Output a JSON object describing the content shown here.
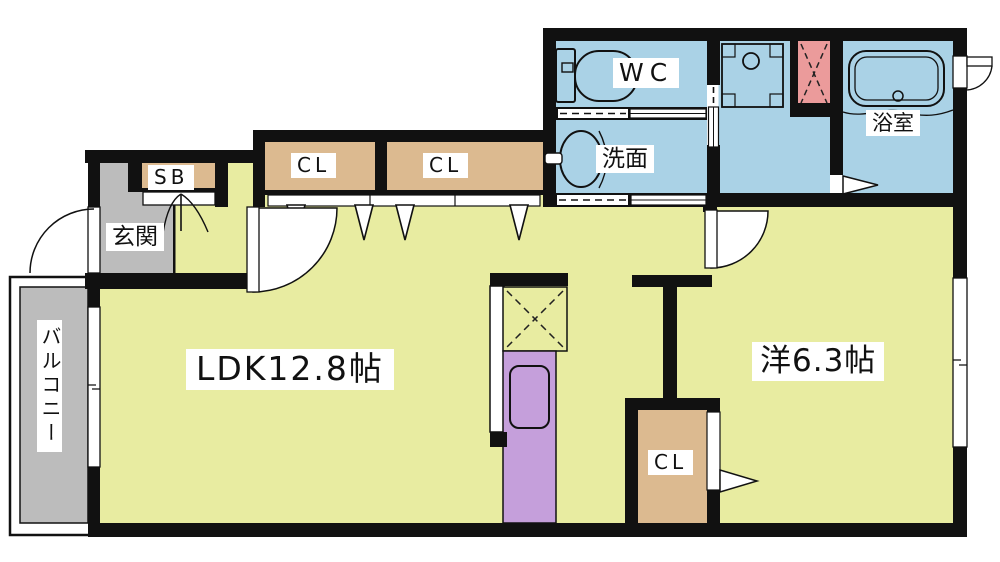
{
  "page": {
    "type": "apartment-floor-plan",
    "background": "#ffffff"
  },
  "rooms": {
    "ldk": {
      "label": "LDK12.8帖",
      "area_jo": 12.8,
      "floor_color": "#e8eca1"
    },
    "western_room": {
      "label": "洋6.3帖",
      "area_jo": 6.3,
      "floor_color": "#e8eca1"
    },
    "wc": {
      "label": "WC",
      "floor_color": "#aad2e6"
    },
    "washroom": {
      "label": "洗面",
      "floor_color": "#aad2e6"
    },
    "bathroom": {
      "label": "浴室",
      "floor_color": "#aad2e6"
    },
    "entrance": {
      "label": "玄関",
      "floor_color": "#bcbcbc"
    },
    "shoe_box": {
      "label": "SB",
      "floor_color": "#dcba90"
    },
    "closet_1": {
      "label": "CL",
      "floor_color": "#dcba90"
    },
    "closet_2": {
      "label": "CL",
      "floor_color": "#dcba90"
    },
    "closet_3": {
      "label": "CL",
      "floor_color": "#dcba90"
    },
    "balcony": {
      "label": "バルコニー",
      "floor_color": "#bcbcbc"
    }
  },
  "fixtures": [
    "toilet-icon",
    "washbasin-icon",
    "bathtub-icon",
    "washing-machine-pan-icon",
    "kitchen-counter-icon",
    "kitchen-sink-icon",
    "refrigerator-space-icon",
    "hatched-unit-icon",
    "door-swing-icon",
    "folding-door-icon",
    "sliding-door-icon",
    "window-icon"
  ],
  "colors": {
    "wall": "#111111",
    "room_yellow": "#e8eca1",
    "wet_area_blue": "#aad2e6",
    "closet_tan": "#dcba90",
    "entrance_balcony_gray": "#bcbcbc",
    "kitchen_purple": "#c59fdb",
    "hatch_pink": "#eb9b9b",
    "label_background": "#ffffff",
    "label_text": "#111111"
  }
}
